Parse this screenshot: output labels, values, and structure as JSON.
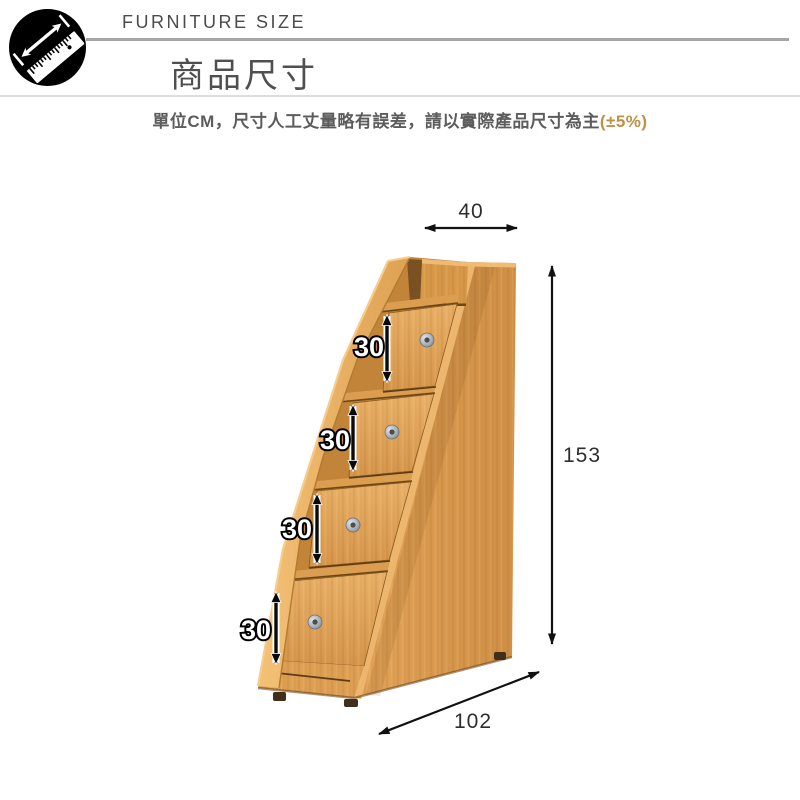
{
  "header": {
    "brand_label": "FURNITURE SIZE",
    "title": "商品尺寸",
    "subtitle_main": "單位CM，尺寸人工丈量略有誤差，請以實際產品尺寸為主",
    "subtitle_tolerance": "(±5%)",
    "icon": "measure-ruler-icon"
  },
  "diagram": {
    "product": "staircase-storage-cabinet-with-4-drawers",
    "unit": "CM",
    "dims": {
      "top_width": "40",
      "height": "153",
      "depth": "102",
      "step_heights": [
        "30",
        "30",
        "30",
        "30"
      ]
    },
    "colors": {
      "wood_base": "#dc9e55",
      "wood_light": "#edb267",
      "wood_recess": "#c18438",
      "arrow_black": "#111111",
      "tolerance_orange": "#be9145",
      "divider_gray": "#a6a6a6"
    }
  }
}
